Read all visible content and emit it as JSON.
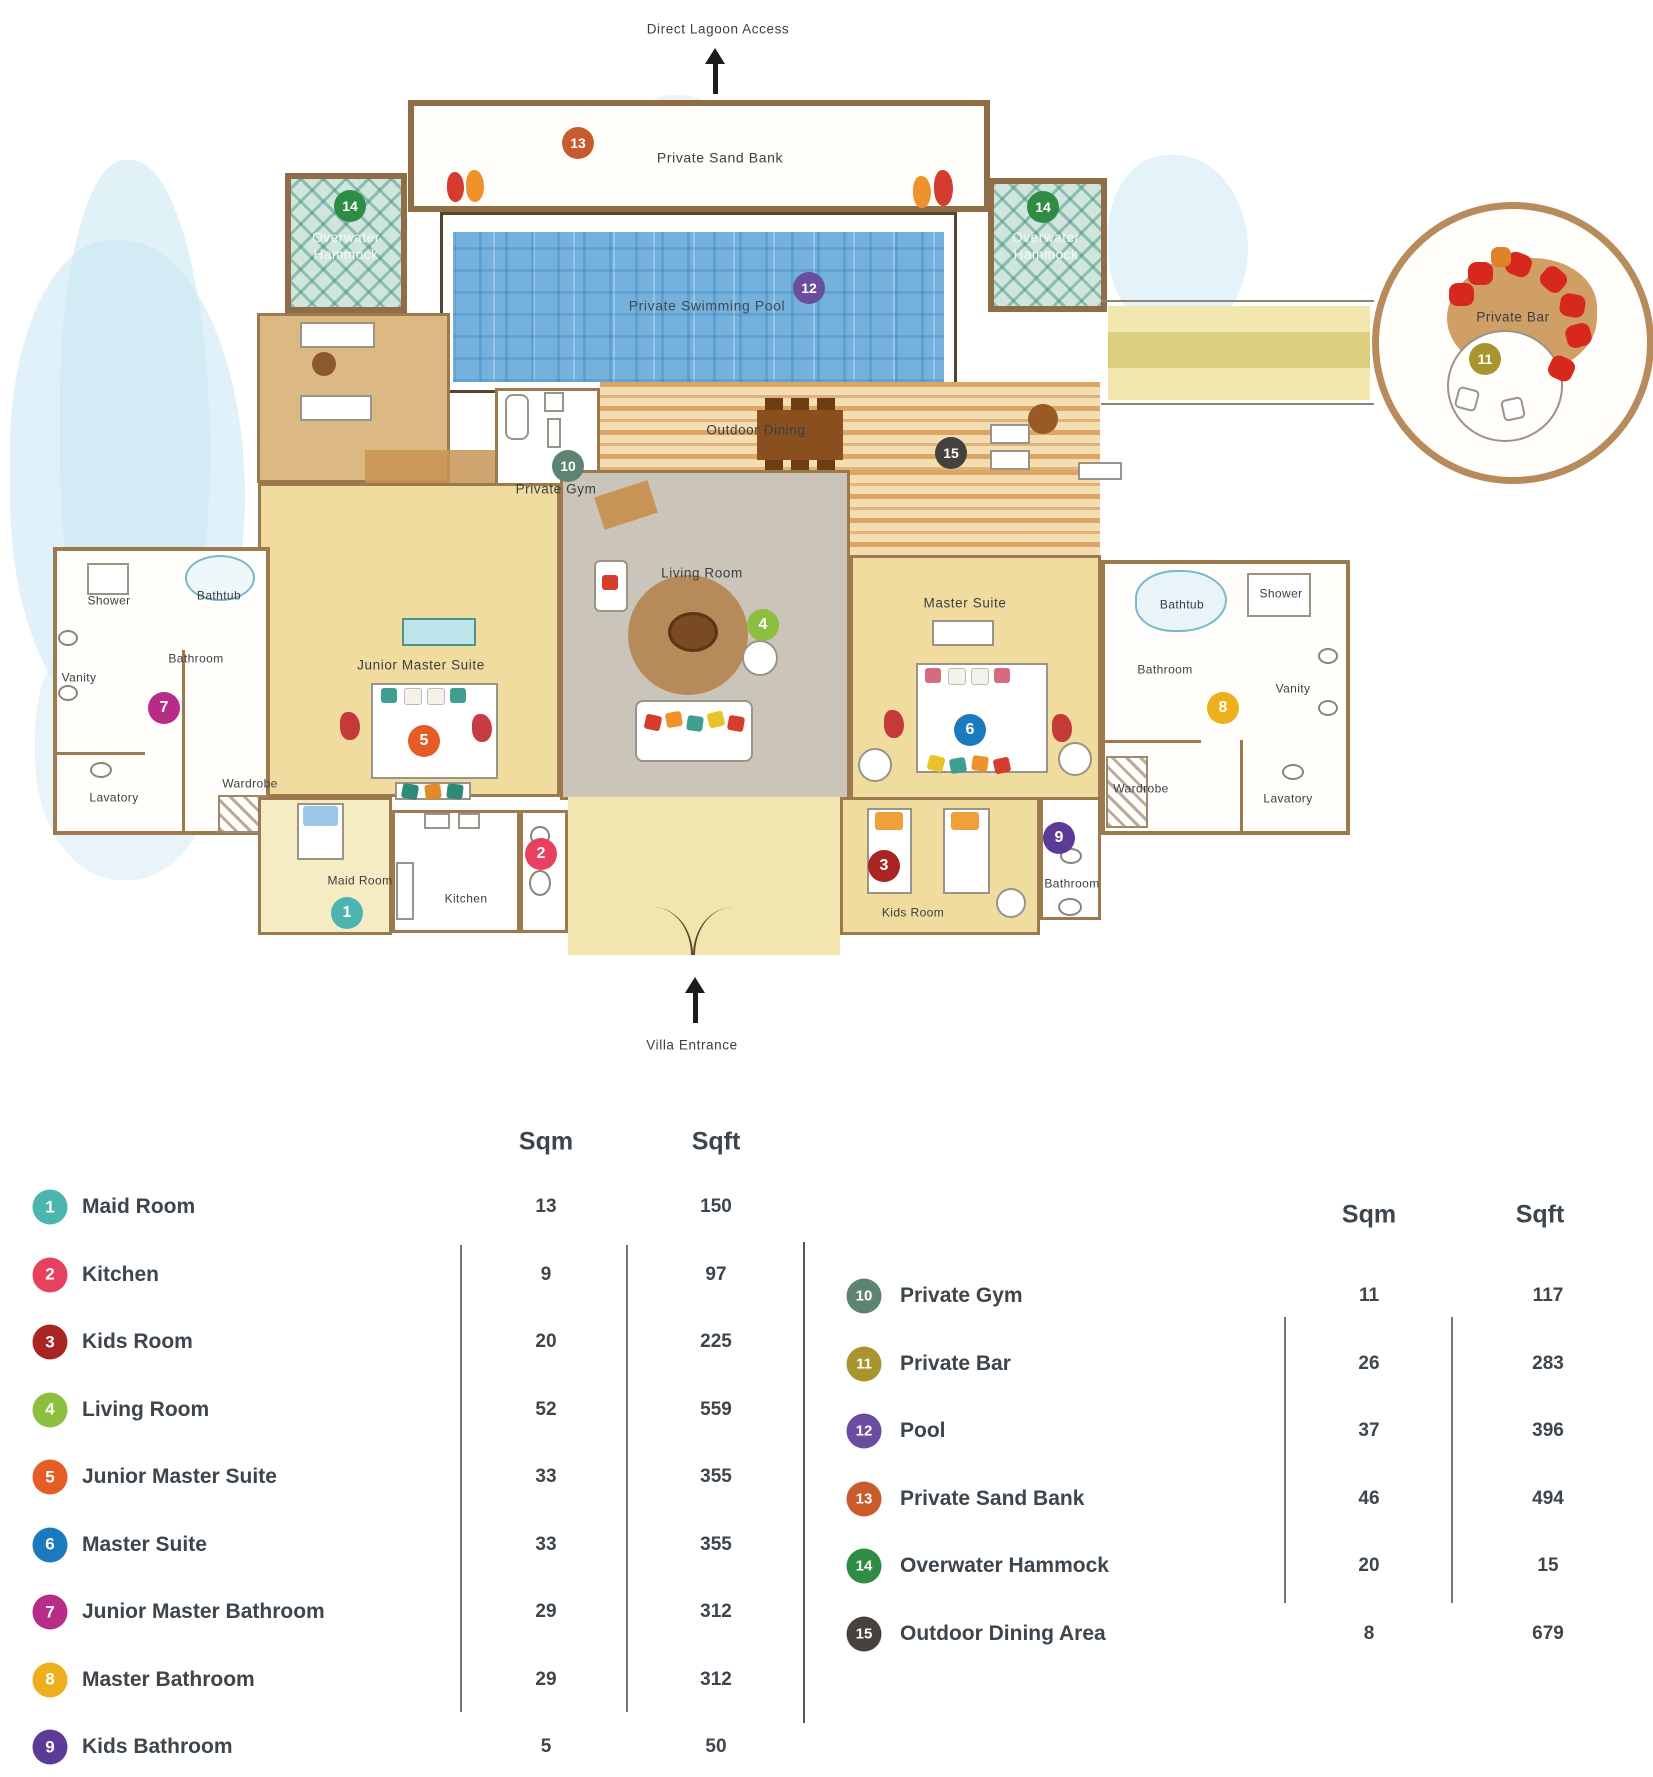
{
  "marker_colors": {
    "1": "#4cb5b0",
    "2": "#e8415f",
    "3": "#a92423",
    "4": "#8cbf3f",
    "5": "#e55c25",
    "6": "#1d79be",
    "7": "#b62c87",
    "8": "#edb01c",
    "9": "#5c3b97",
    "10": "#5d8372",
    "11": "#a9952f",
    "12": "#6a4d9f",
    "13": "#c75b2e",
    "14": "#2e8c44",
    "15": "#45413e"
  },
  "plan": {
    "lagoon_label": "Direct Lagoon Access",
    "entrance_label": "Villa Entrance",
    "labels": [
      {
        "id": "private-sand-bank",
        "text": "Private Sand Bank",
        "x": 720,
        "y": 158,
        "cls": "big"
      },
      {
        "id": "overwater-hammock-left",
        "text": "Overwater\nHammock",
        "x": 346,
        "y": 247,
        "cls": "light"
      },
      {
        "id": "overwater-hammock-right",
        "text": "Overwater\nHammock",
        "x": 1046,
        "y": 247,
        "cls": "light"
      },
      {
        "id": "private-swimming-pool",
        "text": "Private Swimming Pool",
        "x": 707,
        "y": 306,
        "cls": "pool"
      },
      {
        "id": "private-gym",
        "text": "Private Gym",
        "x": 556,
        "y": 490,
        "cls": ""
      },
      {
        "id": "outdoor-dining",
        "text": "Outdoor Dining",
        "x": 756,
        "y": 431,
        "cls": ""
      },
      {
        "id": "private-bar",
        "text": "Private Bar",
        "x": 1513,
        "y": 318,
        "cls": ""
      },
      {
        "id": "living-room",
        "text": "Living Room",
        "x": 702,
        "y": 574,
        "cls": ""
      },
      {
        "id": "junior-master-suite",
        "text": "Junior Master Suite",
        "x": 421,
        "y": 666,
        "cls": ""
      },
      {
        "id": "master-suite",
        "text": "Master Suite",
        "x": 965,
        "y": 604,
        "cls": ""
      },
      {
        "id": "shower-left",
        "text": "Shower",
        "x": 109,
        "y": 601,
        "cls": "small"
      },
      {
        "id": "bathtub-left",
        "text": "Bathtub",
        "x": 219,
        "y": 596,
        "cls": "small"
      },
      {
        "id": "bathroom-left",
        "text": "Bathroom",
        "x": 196,
        "y": 659,
        "cls": "small"
      },
      {
        "id": "vanity-left",
        "text": "Vanity",
        "x": 79,
        "y": 678,
        "cls": "small"
      },
      {
        "id": "lavatory-left",
        "text": "Lavatory",
        "x": 114,
        "y": 798,
        "cls": "small"
      },
      {
        "id": "wardrobe-left",
        "text": "Wardrobe",
        "x": 250,
        "y": 784,
        "cls": "small"
      },
      {
        "id": "bathtub-right",
        "text": "Bathtub",
        "x": 1182,
        "y": 605,
        "cls": "small"
      },
      {
        "id": "shower-right",
        "text": "Shower",
        "x": 1281,
        "y": 594,
        "cls": "small"
      },
      {
        "id": "bathroom-right",
        "text": "Bathroom",
        "x": 1165,
        "y": 670,
        "cls": "small"
      },
      {
        "id": "vanity-right",
        "text": "Vanity",
        "x": 1293,
        "y": 689,
        "cls": "small"
      },
      {
        "id": "wardrobe-right",
        "text": "Wardrobe",
        "x": 1141,
        "y": 789,
        "cls": "small"
      },
      {
        "id": "lavatory-right",
        "text": "Lavatory",
        "x": 1288,
        "y": 799,
        "cls": "small"
      },
      {
        "id": "maid-room",
        "text": "Maid Room",
        "x": 360,
        "y": 881,
        "cls": "small"
      },
      {
        "id": "kitchen",
        "text": "Kitchen",
        "x": 466,
        "y": 899,
        "cls": "small"
      },
      {
        "id": "kids-room",
        "text": "Kids Room",
        "x": 913,
        "y": 913,
        "cls": "small"
      },
      {
        "id": "kids-bathroom",
        "text": "Bathroom",
        "x": 1072,
        "y": 884,
        "cls": "small"
      }
    ],
    "markers": [
      {
        "n": 1,
        "x": 347,
        "y": 913
      },
      {
        "n": 2,
        "x": 541,
        "y": 854
      },
      {
        "n": 3,
        "x": 884,
        "y": 866
      },
      {
        "n": 4,
        "x": 763,
        "y": 625
      },
      {
        "n": 5,
        "x": 424,
        "y": 741
      },
      {
        "n": 6,
        "x": 970,
        "y": 730
      },
      {
        "n": 7,
        "x": 164,
        "y": 708
      },
      {
        "n": 8,
        "x": 1223,
        "y": 708
      },
      {
        "n": 9,
        "x": 1059,
        "y": 838
      },
      {
        "n": 10,
        "x": 568,
        "y": 466
      },
      {
        "n": 11,
        "x": 1485,
        "y": 359
      },
      {
        "n": 12,
        "x": 809,
        "y": 288
      },
      {
        "n": 13,
        "x": 578,
        "y": 143
      },
      {
        "n": 14,
        "x": 350,
        "y": 206
      },
      {
        "n": 14,
        "x": 1043,
        "y": 207
      },
      {
        "n": 15,
        "x": 951,
        "y": 453
      }
    ]
  },
  "legend": {
    "columns": [
      "Sqm",
      "Sqft"
    ],
    "tables": [
      {
        "rows": [
          {
            "n": 1,
            "label": "Maid Room",
            "sqm": "13",
            "sqft": "150"
          },
          {
            "n": 2,
            "label": "Kitchen",
            "sqm": "9",
            "sqft": "97"
          },
          {
            "n": 3,
            "label": "Kids Room",
            "sqm": "20",
            "sqft": "225"
          },
          {
            "n": 4,
            "label": "Living Room",
            "sqm": "52",
            "sqft": "559"
          },
          {
            "n": 5,
            "label": "Junior Master Suite",
            "sqm": "33",
            "sqft": "355"
          },
          {
            "n": 6,
            "label": "Master Suite",
            "sqm": "33",
            "sqft": "355"
          },
          {
            "n": 7,
            "label": "Junior Master Bathroom",
            "sqm": "29",
            "sqft": "312"
          },
          {
            "n": 8,
            "label": "Master Bathroom",
            "sqm": "29",
            "sqft": "312"
          },
          {
            "n": 9,
            "label": "Kids Bathroom",
            "sqm": "5",
            "sqft": "50"
          }
        ]
      },
      {
        "rows": [
          {
            "n": 10,
            "label": "Private Gym",
            "sqm": "11",
            "sqft": "117"
          },
          {
            "n": 11,
            "label": "Private Bar",
            "sqm": "26",
            "sqft": "283"
          },
          {
            "n": 12,
            "label": "Pool",
            "sqm": "37",
            "sqft": "396"
          },
          {
            "n": 13,
            "label": "Private Sand Bank",
            "sqm": "46",
            "sqft": "494"
          },
          {
            "n": 14,
            "label": "Overwater Hammock",
            "sqm": "20",
            "sqft": "15"
          },
          {
            "n": 15,
            "label": "Outdoor Dining Area",
            "sqm": "8",
            "sqft": "679"
          }
        ]
      }
    ]
  }
}
